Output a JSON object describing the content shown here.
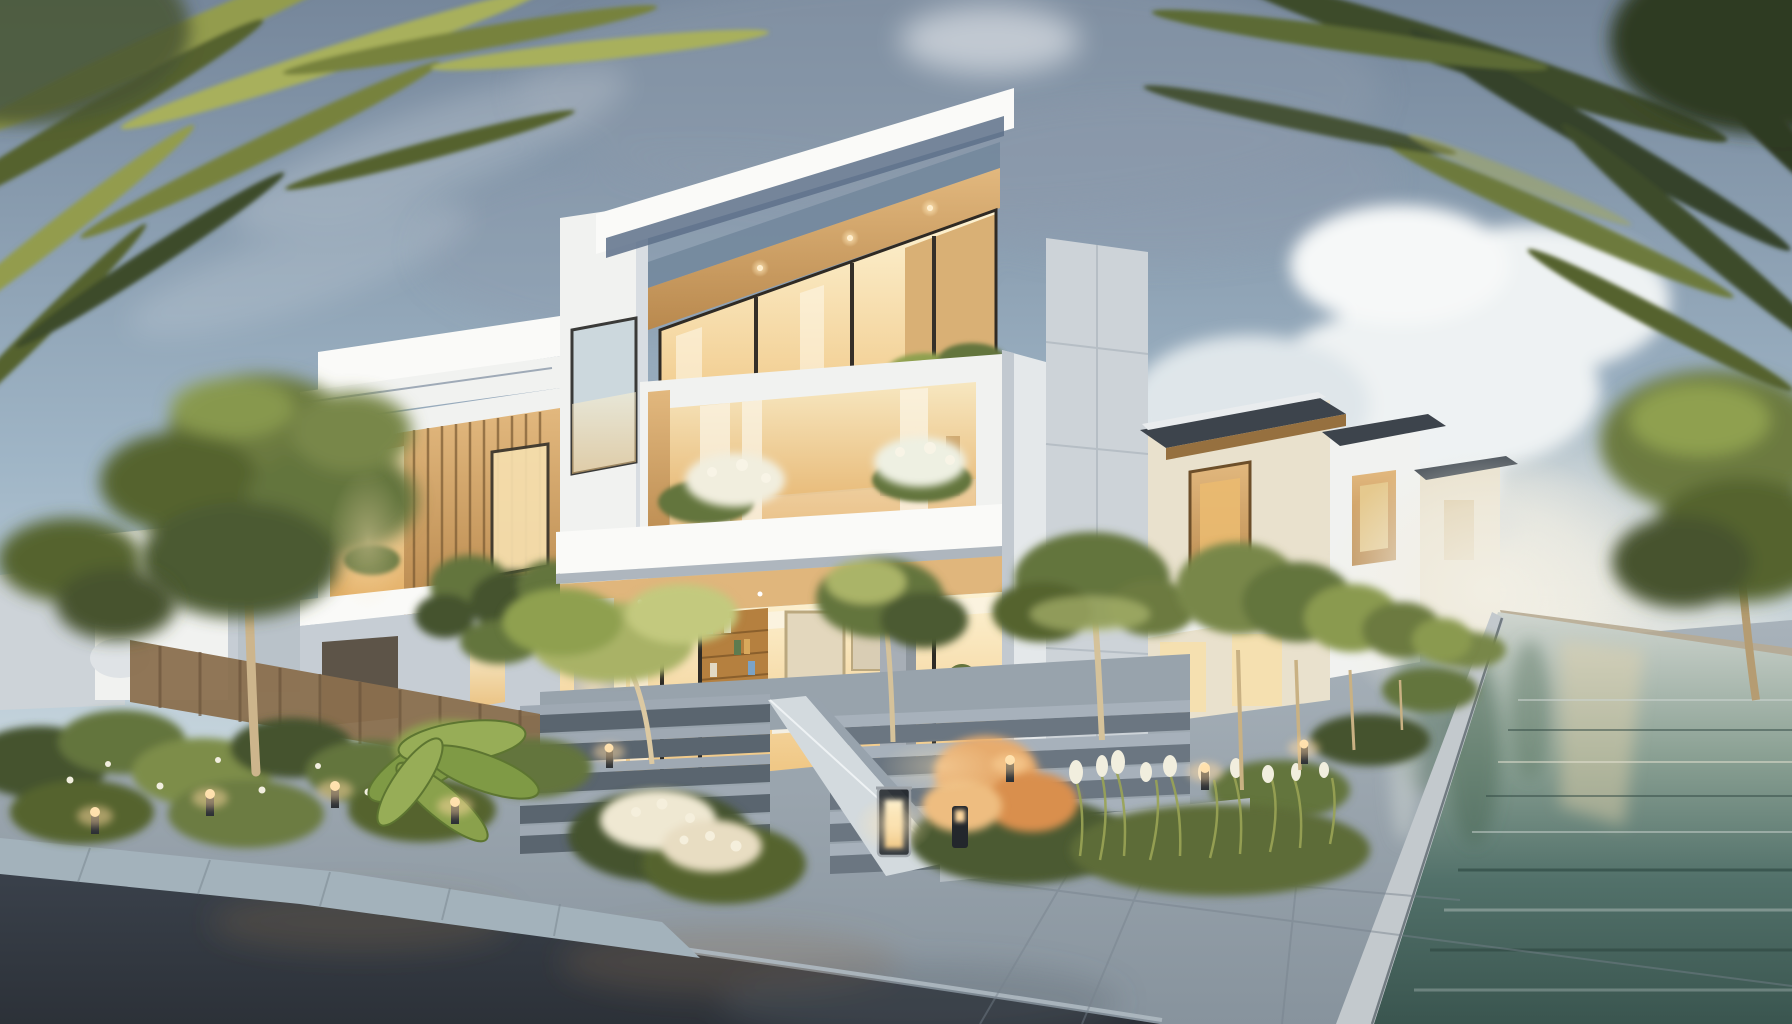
{
  "scene": {
    "type": "architectural-rendering",
    "time_of_day": "dusk",
    "subject": "modern three-story villa community with landscaped street and reflecting canal",
    "regions": [
      "sky",
      "clouds",
      "palm-fronds",
      "distant-houses",
      "left-villa",
      "main-villa",
      "right-pier",
      "right-villa-row",
      "canal-water",
      "street",
      "sidewalk",
      "entrance-steps",
      "garden-beds",
      "trees",
      "path-lights",
      "lantern"
    ]
  },
  "colors": {
    "sky_top": "#76879b",
    "sky_mid": "#9fb5c6",
    "sky_low": "#d3dfe3",
    "haze": "#f2efe4",
    "cloud_white": "#eef2f3",
    "cloud_gray": "#8e9cab",
    "wall_white": "#f1f2f0",
    "wall_bright": "#fafaf8",
    "wall_shade": "#c6cdd4",
    "wall_cream": "#e9e1cd",
    "wall_gray": "#cdd3d8",
    "fascia_blue": "#5d7089",
    "parapet_glass": "#70869b",
    "roof_dark": "#3d444c",
    "wood": "#c89a5e",
    "wood_dark": "#96703f",
    "wood_light": "#e0b67c",
    "glass_warm": "#f6dfae",
    "glass_amber": "#eaba70",
    "glass_cool": "#ccd8dd",
    "interior_wall": "#f5e6c4",
    "book_wood": "#b5803f",
    "foliage_dark": "#45522d",
    "foliage_mid": "#64743c",
    "foliage_light": "#8fa050",
    "foliage_pale": "#b7c178",
    "frond_olive": "#939c4e",
    "frond_dark": "#3e4b2a",
    "trunk": "#cdb58c",
    "fence_wood": "#8a6f4e",
    "flower_white": "#f1eede",
    "flower_peach": "#e7ac6e",
    "water_deep": "#3f5c55",
    "water_mid": "#7f978c",
    "water_pale": "#ccd3cf",
    "stone": "#98a3ac",
    "stone_dark": "#606b75",
    "asphalt": "#32383f",
    "curb": "#aeb9c1",
    "step_top": "#9fa9b3",
    "step_face": "#5a656f",
    "concrete": "#b9bfc6",
    "glow": "#ffd9a0",
    "glow_deep": "#f0ac5c",
    "bank_stone": "#b7ab93"
  }
}
